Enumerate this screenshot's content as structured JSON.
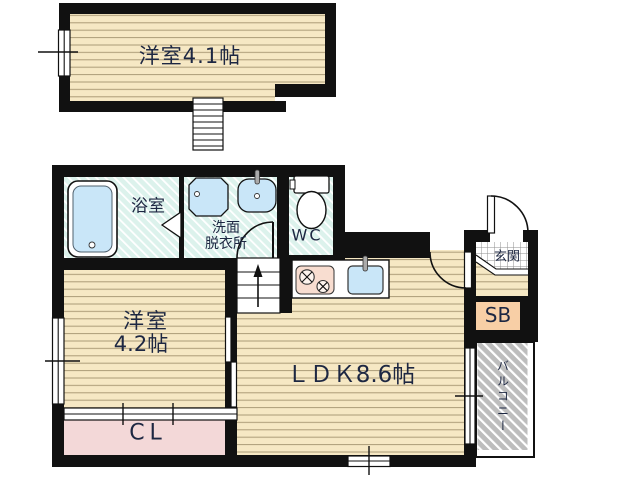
{
  "rooms": {
    "upper_bedroom": "洋室4.1帖",
    "bathroom": "浴室",
    "washroom_line1": "洗面",
    "washroom_line2": "脱衣所",
    "wc": "WC",
    "bedroom_line1": "洋室",
    "bedroom_line2": "4.2帖",
    "ldk": "ＬＤＫ8.6帖",
    "closet": "CL",
    "entrance": "玄関",
    "shoebox": "SB",
    "balcony": "バルコニー"
  },
  "colors": {
    "wall": "#111111",
    "wood_floor": "#f6e8c4",
    "wood_line": "#ab9b77",
    "wet_floor": "#dcf2ec",
    "closet_floor": "#f3d8d8",
    "shoebox_fill": "#f8cfa6",
    "fixture_blue": "#c9e6f8",
    "stove_fill": "#f8ddd0",
    "balcony_gray": "#bdbdbd",
    "text": "#1d2742"
  }
}
